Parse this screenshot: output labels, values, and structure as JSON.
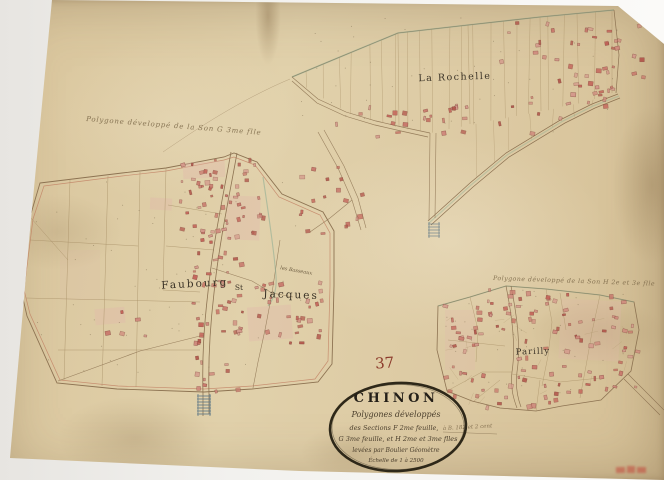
{
  "artifact": {
    "sheet_number": "37"
  },
  "cartouche": {
    "title": "CHINON",
    "line1": "Polygones développés",
    "line2": "des Sections F 2me feuille,",
    "line3": "G 3me feuille, et H 2me et 3me flles",
    "line4": "levées par Boulier Géomètre",
    "line5": "Échelle de 1 à 2500"
  },
  "annotations": {
    "section_g": "Polygone développé de la Son G 3me flle",
    "section_h": "Polygone développé de la Son H 2e et 3e flle",
    "side_note": "à B. 182 et 2 cent"
  },
  "labels": {
    "la_rochelle": "La Rochelle",
    "faubourg": "Faubourg",
    "saint": "St",
    "jacques": "Jacques",
    "les_basseaux": "les Basseaux",
    "parilly": "Parilly"
  },
  "colors": {
    "paper": "#ddcba3",
    "ink": "#8d7352",
    "building_red": "#c4655a",
    "road_green": "#8fae94",
    "handwriting": "#7d6a4a",
    "cartouche_ink": "#2e2819",
    "number_red": "#8c3a2b",
    "stamp_red": "#c2473a"
  }
}
